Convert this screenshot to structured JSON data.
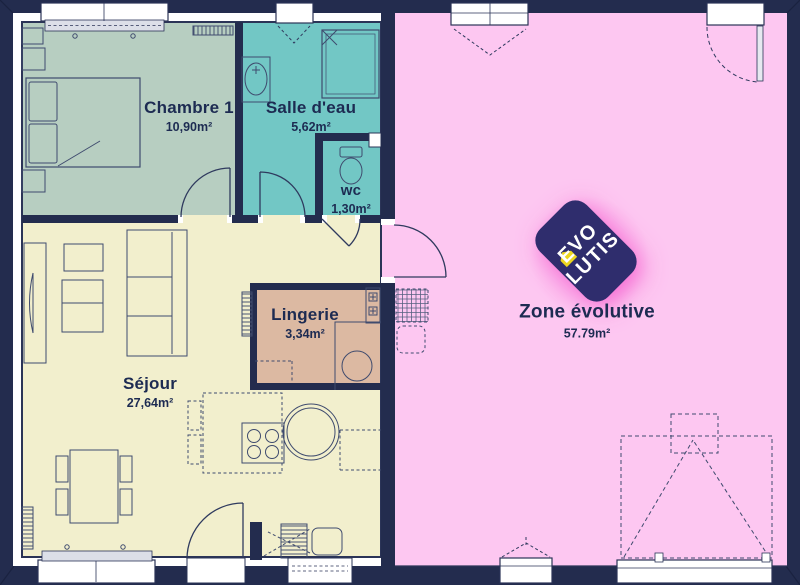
{
  "plan": {
    "rooms": [
      {
        "name": "Chambre 1",
        "area": "10,90m²"
      },
      {
        "name": "Salle d'eau",
        "area": "5,62m²"
      },
      {
        "name": "wc",
        "area": "1,30m²"
      },
      {
        "name": "Séjour",
        "area": "27,64m²"
      },
      {
        "name": "Lingerie",
        "area": "3,34m²"
      },
      {
        "name": "Zone évolutive",
        "area": "57.79m²"
      }
    ],
    "logo": {
      "line1": "EVO",
      "line2": "LUTIS"
    },
    "colors": {
      "wall": "#232c4e",
      "room_chambre": "#b7cec1",
      "room_salle_deau": "#72c7c5",
      "room_sejour": "#f2efcd",
      "room_lingerie": "#dcb9a2",
      "room_zone": "#fdc7f1",
      "logo_bg": "#2f2d6d",
      "logo_accent": "#ecd61f",
      "label": "#1d2b52",
      "glow": "#f57fd7"
    }
  }
}
